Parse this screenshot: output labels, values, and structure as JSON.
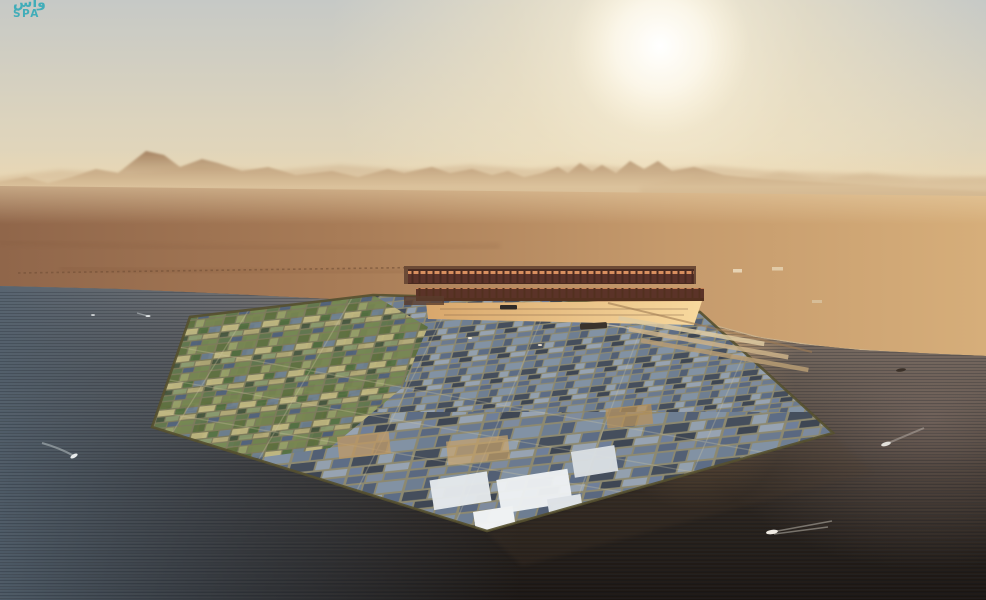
{
  "watermark": {
    "line1": "واس",
    "line2": "SPA",
    "color": "#3aacb9"
  },
  "scene": {
    "description": "Aerial rendering of an octagonal floating industrial port city in the sea at hazy golden daylight, desert mountains behind, container port on the city's far edge, small boats with wakes in dark water",
    "elements": [
      "sky",
      "sun-glow",
      "mountain-ranges",
      "desert-coastline",
      "sea",
      "octagon-city",
      "green-farm-blocks",
      "container-port",
      "harbor-basin",
      "boats",
      "spa-watermark"
    ],
    "colors": {
      "sky_top": "#c6c9c6",
      "sky_horizon": "#ecd9b2",
      "sun_core": "#ffffff",
      "mountain_haze": "#9a7554",
      "desert_west": "#90664a",
      "desert_east": "#d6ae7a",
      "sea_surface": "#8d8078",
      "sea_deep": "#1a1512",
      "sea_left_blue": "#51606e",
      "sun_reflection": "#ffe2ac",
      "shore_mauve": "#8b7870",
      "city_base_road": "#8a8468",
      "island_edge": "#55502f",
      "block_blue": "#6e7e92",
      "block_dark": "#3e4653",
      "block_green": "#5c6e3a",
      "block_light": "#97a3b2",
      "port_container": "#4a2a20",
      "basin_gold": "#f8d99e",
      "boat_white": "#e8ebec"
    }
  }
}
